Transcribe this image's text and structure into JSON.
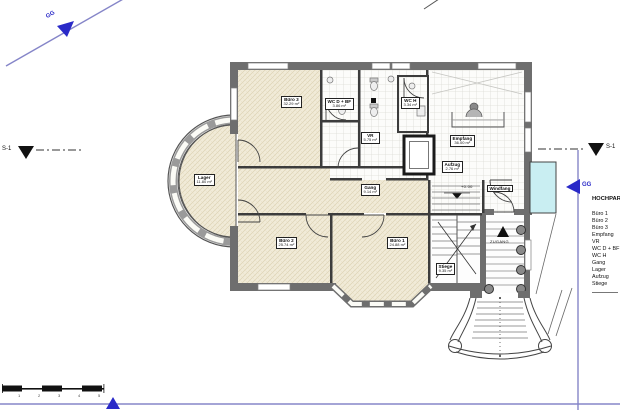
{
  "section_markers": {
    "gg": "GG",
    "s1": "S-1"
  },
  "site": {
    "zugang_label": "ZUGANG",
    "level_label": "+0.00"
  },
  "rooms": [
    {
      "name": "Büro 3",
      "area": "32.29 m²"
    },
    {
      "name": "WC D + BF",
      "area": "3.86 m²"
    },
    {
      "name": "WC H",
      "area": "3.34 m²"
    },
    {
      "name": "VR",
      "area": "5.75 m²"
    },
    {
      "name": "Empfang",
      "area": "36.00 m²"
    },
    {
      "name": "Aufzug",
      "area": "2.76 m²"
    },
    {
      "name": "Windfang",
      "area": ""
    },
    {
      "name": "Gang",
      "area": "9.14 m²"
    },
    {
      "name": "Lager",
      "area": "11.80 m²"
    },
    {
      "name": "Büro 2",
      "area": "25.74 m²"
    },
    {
      "name": "Büro 1",
      "area": "24.88 m²"
    },
    {
      "name": "Stiege",
      "area": "9.35 m²"
    }
  ],
  "legend": {
    "title": "HOCHPARTERRE",
    "items": [
      "Büro 1",
      "Büro 2",
      "Büro 3",
      "Empfang",
      "VR",
      "WC D + BF",
      "WC H",
      "Gang",
      "Lager",
      "Aufzug",
      "Stiege"
    ]
  },
  "scale_bar": {
    "ticks": [
      "1",
      "2",
      "3",
      "4",
      "5"
    ]
  },
  "colors": {
    "wall": "#6e6e6e",
    "floor": "#f1ebd8",
    "accent_blue": "#2a2ac8",
    "highlight_cyan": "#c9eef2"
  }
}
